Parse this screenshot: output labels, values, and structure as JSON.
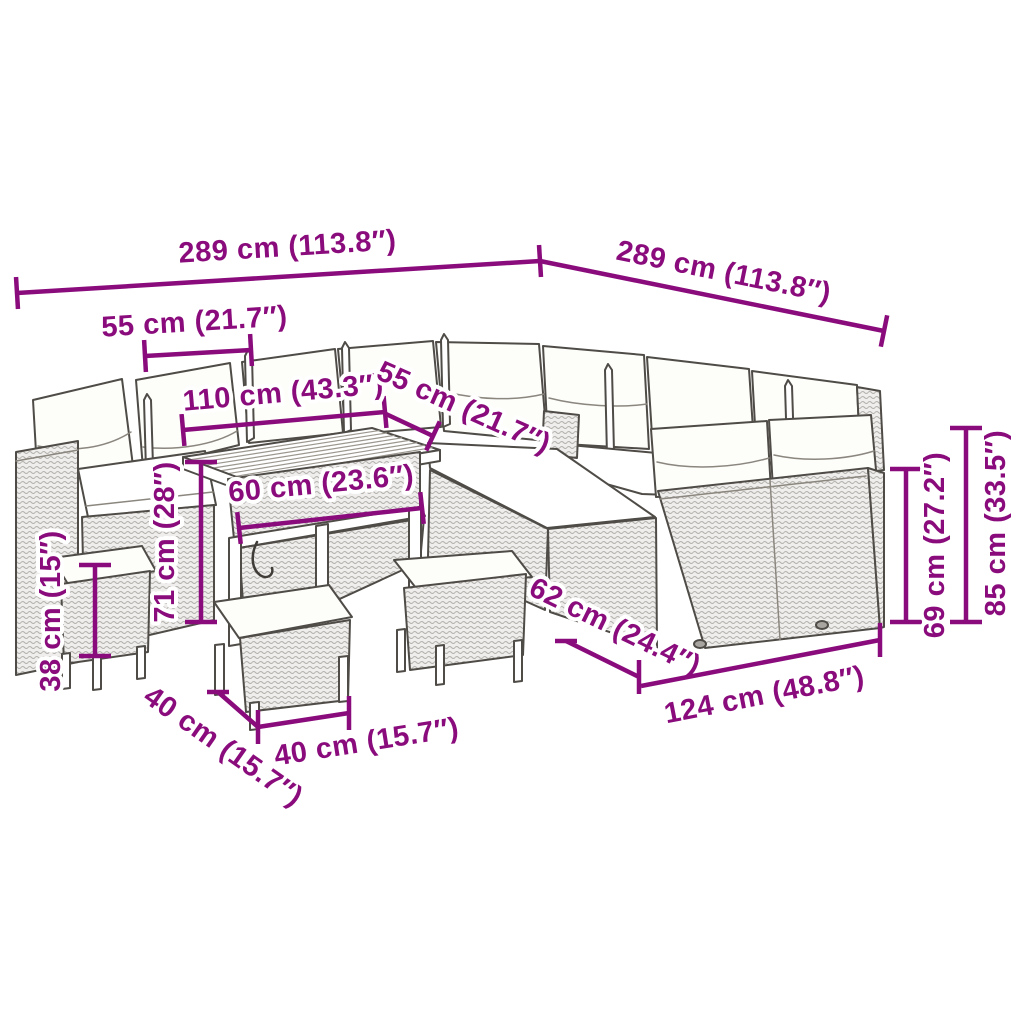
{
  "diagram": {
    "kind": "product dimension diagram",
    "subject": "rattan garden lounge set with table and stools"
  },
  "colors": {
    "dimension": "#8A0C7C",
    "background": "#ffffff",
    "line_art": "#4f4c47"
  },
  "dimensions": [
    {
      "id": "total-width-left",
      "label": "289 cm (113.8″)"
    },
    {
      "id": "total-width-right",
      "label": "289 cm (113.8″)"
    },
    {
      "id": "seat-width-left",
      "label": "55 cm (21.7″)"
    },
    {
      "id": "table-length",
      "label": "110 cm (43.3″)"
    },
    {
      "id": "seat-width-mid",
      "label": "55 cm (21.7″)"
    },
    {
      "id": "table-width",
      "label": "60 cm (23.6″)"
    },
    {
      "id": "table-height",
      "label": "71 cm (28″)"
    },
    {
      "id": "stool-height",
      "label": "38 cm (15″)"
    },
    {
      "id": "stool-depth",
      "label": "40 cm (15.7″)"
    },
    {
      "id": "stool-width",
      "label": "40 cm (15.7″)"
    },
    {
      "id": "sofa-depth",
      "label": "62 cm (24.4″)"
    },
    {
      "id": "sofa-width",
      "label": "124 cm (48.8″)"
    },
    {
      "id": "seat-back-height",
      "label": "69 cm (27.2″)"
    },
    {
      "id": "total-height",
      "label": "85 cm (33.5″)"
    }
  ]
}
